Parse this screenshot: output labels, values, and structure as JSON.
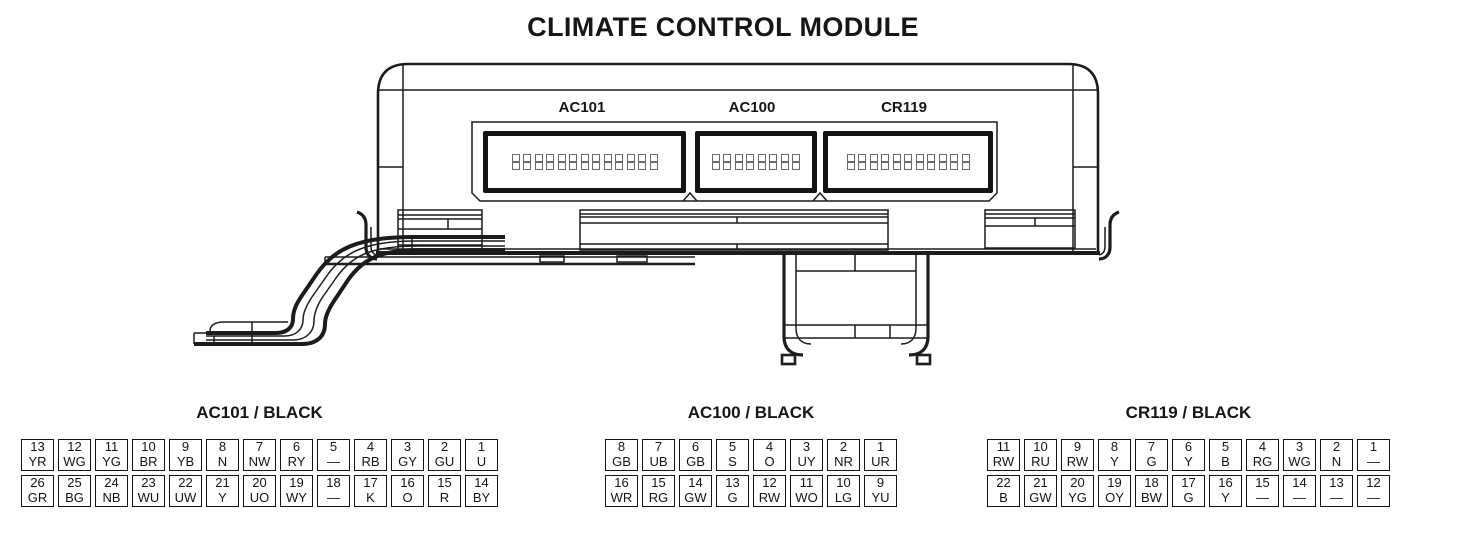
{
  "title": "CLIMATE CONTROL MODULE",
  "colors": {
    "line": "#1c1c1c",
    "background": "#ffffff",
    "text": "#141414"
  },
  "module": {
    "connectors": [
      {
        "label": "AC101",
        "pins_per_row": 13,
        "pin_rows": 2
      },
      {
        "label": "AC100",
        "pins_per_row": 8,
        "pin_rows": 2
      },
      {
        "label": "CR119",
        "pins_per_row": 11,
        "pin_rows": 2
      }
    ]
  },
  "pinout_tables": [
    {
      "title": "AC101 / BLACK",
      "rows": [
        [
          {
            "pin": "13",
            "code": "YR"
          },
          {
            "pin": "12",
            "code": "WG"
          },
          {
            "pin": "11",
            "code": "YG"
          },
          {
            "pin": "10",
            "code": "BR"
          },
          {
            "pin": "9",
            "code": "YB"
          },
          {
            "pin": "8",
            "code": "N"
          },
          {
            "pin": "7",
            "code": "NW"
          },
          {
            "pin": "6",
            "code": "RY"
          },
          {
            "pin": "5",
            "code": "—"
          },
          {
            "pin": "4",
            "code": "RB"
          },
          {
            "pin": "3",
            "code": "GY"
          },
          {
            "pin": "2",
            "code": "GU"
          },
          {
            "pin": "1",
            "code": "U"
          }
        ],
        [
          {
            "pin": "26",
            "code": "GR"
          },
          {
            "pin": "25",
            "code": "BG"
          },
          {
            "pin": "24",
            "code": "NB"
          },
          {
            "pin": "23",
            "code": "WU"
          },
          {
            "pin": "22",
            "code": "UW"
          },
          {
            "pin": "21",
            "code": "Y"
          },
          {
            "pin": "20",
            "code": "UO"
          },
          {
            "pin": "19",
            "code": "WY"
          },
          {
            "pin": "18",
            "code": "—"
          },
          {
            "pin": "17",
            "code": "K"
          },
          {
            "pin": "16",
            "code": "O"
          },
          {
            "pin": "15",
            "code": "R"
          },
          {
            "pin": "14",
            "code": "BY"
          }
        ]
      ]
    },
    {
      "title": "AC100 / BLACK",
      "rows": [
        [
          {
            "pin": "8",
            "code": "GB"
          },
          {
            "pin": "7",
            "code": "UB"
          },
          {
            "pin": "6",
            "code": "GB"
          },
          {
            "pin": "5",
            "code": "S"
          },
          {
            "pin": "4",
            "code": "O"
          },
          {
            "pin": "3",
            "code": "UY"
          },
          {
            "pin": "2",
            "code": "NR"
          },
          {
            "pin": "1",
            "code": "UR"
          }
        ],
        [
          {
            "pin": "16",
            "code": "WR"
          },
          {
            "pin": "15",
            "code": "RG"
          },
          {
            "pin": "14",
            "code": "GW"
          },
          {
            "pin": "13",
            "code": "G"
          },
          {
            "pin": "12",
            "code": "RW"
          },
          {
            "pin": "11",
            "code": "WO"
          },
          {
            "pin": "10",
            "code": "LG"
          },
          {
            "pin": "9",
            "code": "YU"
          }
        ]
      ]
    },
    {
      "title": "CR119 / BLACK",
      "rows": [
        [
          {
            "pin": "11",
            "code": "RW"
          },
          {
            "pin": "10",
            "code": "RU"
          },
          {
            "pin": "9",
            "code": "RW"
          },
          {
            "pin": "8",
            "code": "Y"
          },
          {
            "pin": "7",
            "code": "G"
          },
          {
            "pin": "6",
            "code": "Y"
          },
          {
            "pin": "5",
            "code": "B"
          },
          {
            "pin": "4",
            "code": "RG"
          },
          {
            "pin": "3",
            "code": "WG"
          },
          {
            "pin": "2",
            "code": "N"
          },
          {
            "pin": "1",
            "code": "—"
          }
        ],
        [
          {
            "pin": "22",
            "code": "B"
          },
          {
            "pin": "21",
            "code": "GW"
          },
          {
            "pin": "20",
            "code": "YG"
          },
          {
            "pin": "19",
            "code": "OY"
          },
          {
            "pin": "18",
            "code": "BW"
          },
          {
            "pin": "17",
            "code": "G"
          },
          {
            "pin": "16",
            "code": "Y"
          },
          {
            "pin": "15",
            "code": "—"
          },
          {
            "pin": "14",
            "code": "—"
          },
          {
            "pin": "13",
            "code": "—"
          },
          {
            "pin": "12",
            "code": "—"
          }
        ]
      ]
    }
  ]
}
